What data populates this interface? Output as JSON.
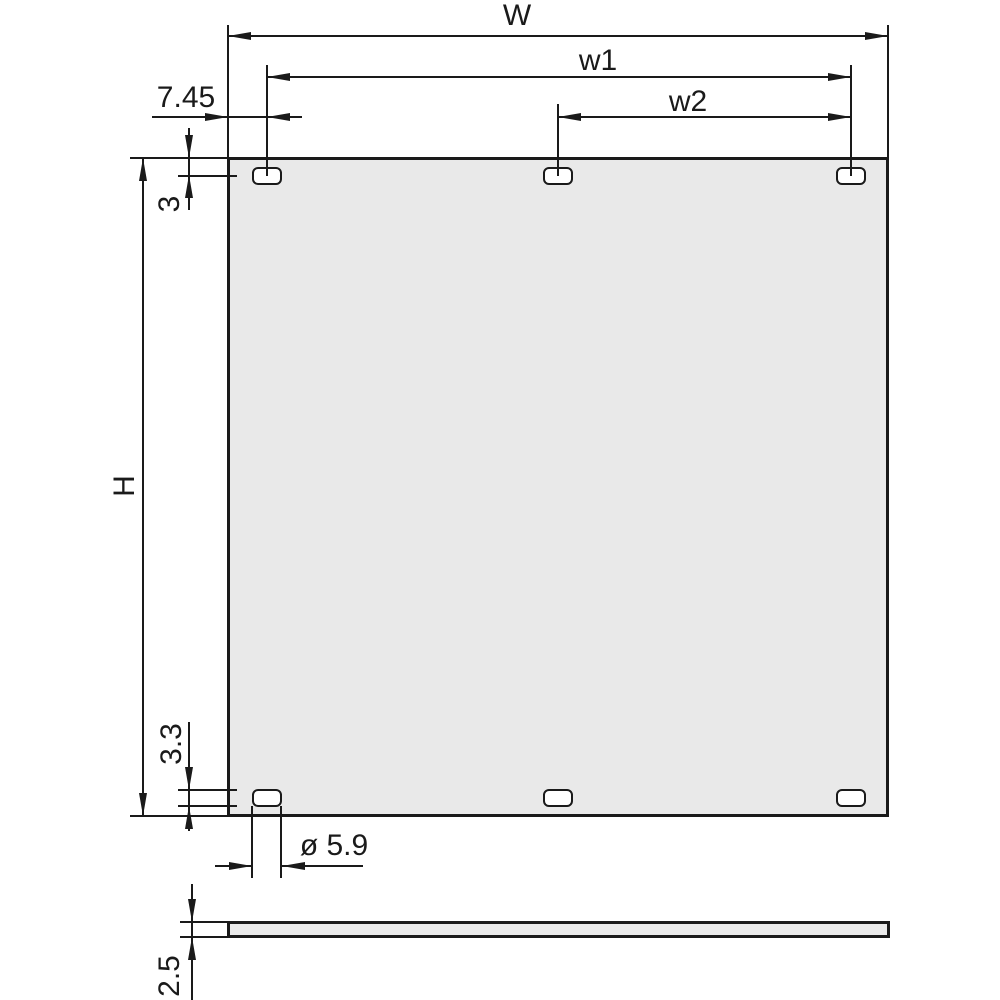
{
  "drawing": {
    "type": "technical-dimension-drawing",
    "subject": "front panel with six oval mounting slots, front view and side (thickness) view",
    "labels": {
      "width": "W",
      "hole_span_outer": "w1",
      "hole_span_inner": "w2",
      "edge_to_first_hole": "7.45",
      "top_edge_to_hole_center": "3",
      "height": "H",
      "hole_height": "3.3",
      "hole_width": "ø 5.9",
      "panel_thickness": "2.5"
    },
    "colors": {
      "line": "#1a1a1a",
      "panel_fill": "#e9e9e9",
      "hole_fill": "#ffffff",
      "background": "#ffffff"
    }
  }
}
